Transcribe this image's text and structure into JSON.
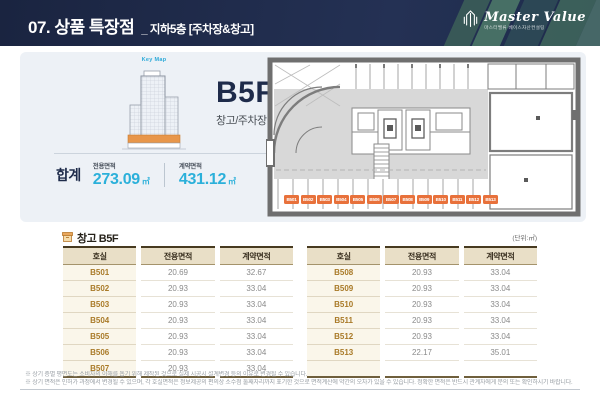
{
  "header": {
    "title": "07. 상품 특장점",
    "subtitle": "_ 지하5층 [주차장&창고]",
    "logo_name": "Master Value",
    "logo_sub": "마스터밸류 베이스자산컨설팅"
  },
  "summary": {
    "keymap_label": "Key Map",
    "floor": "B5F",
    "usage": "창고/주차장",
    "total_label": "합계",
    "exclusive_label": "전용면적",
    "exclusive_value": "273.09",
    "exclusive_unit": "㎡",
    "contract_label": "계약면적",
    "contract_value": "431.12",
    "contract_unit": "㎡"
  },
  "plan": {
    "badges": [
      "B501",
      "B502",
      "B503",
      "B504",
      "B505",
      "B506",
      "B507",
      "B508",
      "B509",
      "B510",
      "B511",
      "B512",
      "B513"
    ]
  },
  "table_section": {
    "icon": "warehouse-box-icon",
    "title": "창고 B5F",
    "unit_note": "(단위:㎡)",
    "columns": [
      "호실",
      "전용면적",
      "계약면적"
    ],
    "left_rows": [
      {
        "room": "B501",
        "exclusive": "20.69",
        "contract": "32.67"
      },
      {
        "room": "B502",
        "exclusive": "20.93",
        "contract": "33.04"
      },
      {
        "room": "B503",
        "exclusive": "20.93",
        "contract": "33.04"
      },
      {
        "room": "B504",
        "exclusive": "20.93",
        "contract": "33.04"
      },
      {
        "room": "B505",
        "exclusive": "20.93",
        "contract": "33.04"
      },
      {
        "room": "B506",
        "exclusive": "20.93",
        "contract": "33.04"
      },
      {
        "room": "B507",
        "exclusive": "20.93",
        "contract": "33.04"
      }
    ],
    "right_rows": [
      {
        "room": "B508",
        "exclusive": "20.93",
        "contract": "33.04"
      },
      {
        "room": "B509",
        "exclusive": "20.93",
        "contract": "33.04"
      },
      {
        "room": "B510",
        "exclusive": "20.93",
        "contract": "33.04"
      },
      {
        "room": "B511",
        "exclusive": "20.93",
        "contract": "33.04"
      },
      {
        "room": "B512",
        "exclusive": "20.93",
        "contract": "33.04"
      },
      {
        "room": "B513",
        "exclusive": "22.17",
        "contract": "35.01"
      },
      {
        "room": "",
        "exclusive": "",
        "contract": ""
      }
    ]
  },
  "footnotes": [
    "※ 상기 층별 평면도는 소비자의 이해를 돕기 위해 제작된 것으로 실제 시공시 설계변경 등의 이유로 변경될 수 있습니다.",
    "※ 상기 면적은 인허가 과정에서 변경될 수 있으며, 각 호실면적은 정보제공의 편의상 소수점 둘째자리까지 표기한 것으로 면적계산에 약간의 오차가 있을 수 있습니다. 정확한 면적은 반드시 관계자에게 문의 또는 확인하시기 바랍니다."
  ],
  "colors": {
    "header_navy": "#1e2b4b",
    "accent_cyan": "#2bb0da",
    "badge_orange": "#e8713b",
    "table_header_bg": "#e9dfc7",
    "panel_bg": "#edf1f6"
  }
}
